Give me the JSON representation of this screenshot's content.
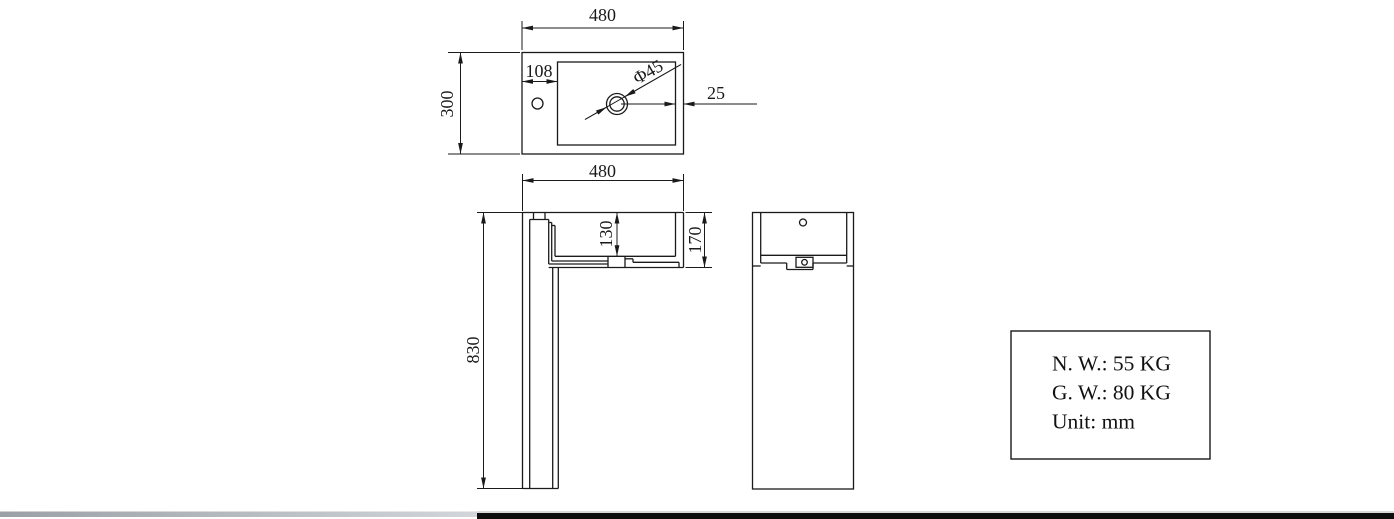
{
  "colors": {
    "line": "#1a1a1a",
    "background": "#ffffff",
    "ground_bar_black": "#0d0d0d",
    "ground_bar_gray_left": "#9aa0a6",
    "ground_bar_gray_right": "#d2d6da"
  },
  "top_view": {
    "width": "480",
    "depth": "300",
    "faucet_hole_offset": "108",
    "drain_diameter": "Φ45",
    "rim_to_basin_gap": "25"
  },
  "front_view": {
    "width": "480",
    "basin_inner_depth": "130",
    "basin_outer_height": "170",
    "total_height": "830"
  },
  "info_box": {
    "net_weight": "N. W.: 55 KG",
    "gross_weight": "G. W.: 80 KG",
    "unit": "Unit: mm"
  }
}
